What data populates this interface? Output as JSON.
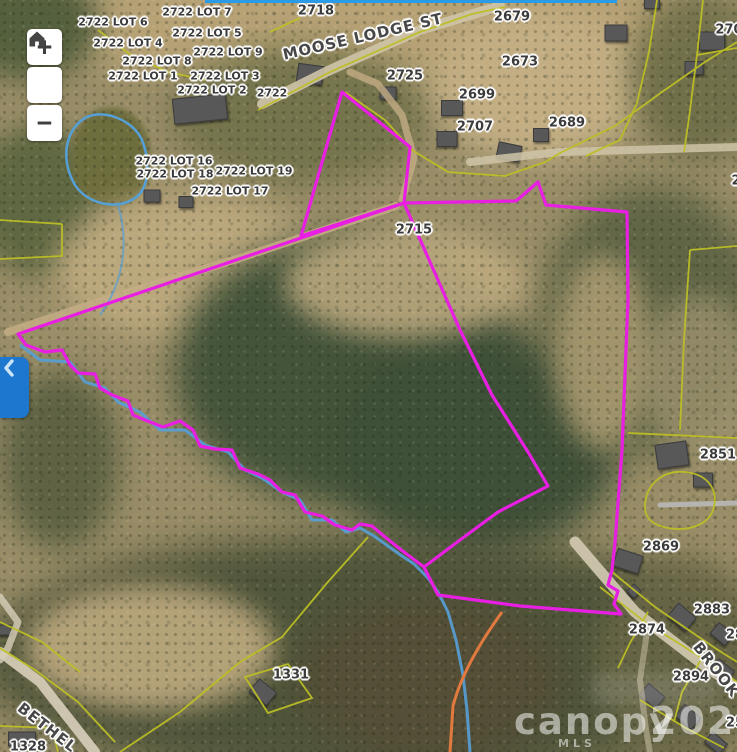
{
  "colors": {
    "selected_boundary": "#e91ee3",
    "parcel_lines": "#bcbf25",
    "water": "#56a0d8",
    "road_casing": "#e2793f",
    "label_text": "#3b3b3b",
    "control_bg": "#ffffff",
    "collapse_bg": "#1d77cf",
    "top_strip": "#2a9be6"
  },
  "controls": {
    "zoom_in": "+",
    "zoom_out": "−",
    "home_icon": "home-icon",
    "collapse_icon": "chevron-left-icon"
  },
  "watermark": {
    "brand": "canopy",
    "mls": "MLS",
    "year": "2025"
  },
  "map": {
    "street_labels": [
      {
        "text": "MOOSE LODGE ST",
        "x": 363,
        "y": 37,
        "rot": -13,
        "size": 15
      },
      {
        "text": "BROOK",
        "x": 716,
        "y": 670,
        "rot": 52,
        "size": 15
      },
      {
        "text": "BETHEL",
        "x": 47,
        "y": 728,
        "rot": 38,
        "size": 15
      }
    ],
    "parcel_labels": [
      {
        "text": "2722 LOT 7",
        "x": 197,
        "y": 12,
        "size": 11
      },
      {
        "text": "2718",
        "x": 316,
        "y": 11,
        "size": 13
      },
      {
        "text": "2722 LOT 6",
        "x": 113,
        "y": 22,
        "size": 11
      },
      {
        "text": "2722 LOT 5",
        "x": 207,
        "y": 33,
        "size": 11
      },
      {
        "text": "2722 LOT 4",
        "x": 128,
        "y": 43,
        "size": 11
      },
      {
        "text": "2722 LOT 9",
        "x": 228,
        "y": 52,
        "size": 11
      },
      {
        "text": "2722 LOT 8",
        "x": 157,
        "y": 61,
        "size": 11
      },
      {
        "text": "2722 LOT 1",
        "x": 143,
        "y": 76,
        "size": 11
      },
      {
        "text": "2722 LOT 3",
        "x": 225,
        "y": 76,
        "size": 11
      },
      {
        "text": "2722 LOT 2",
        "x": 212,
        "y": 90,
        "size": 11
      },
      {
        "text": "2722",
        "x": 272,
        "y": 93,
        "size": 11
      },
      {
        "text": "2679",
        "x": 512,
        "y": 17,
        "size": 13
      },
      {
        "text": "2725",
        "x": 405,
        "y": 76,
        "size": 13
      },
      {
        "text": "2673",
        "x": 520,
        "y": 62,
        "size": 13
      },
      {
        "text": "2699",
        "x": 477,
        "y": 95,
        "size": 13
      },
      {
        "text": "2707",
        "x": 475,
        "y": 127,
        "size": 13
      },
      {
        "text": "2689",
        "x": 567,
        "y": 123,
        "size": 13
      },
      {
        "text": "270",
        "x": 729,
        "y": 30,
        "size": 13
      },
      {
        "text": "2722 LOT 16",
        "x": 174,
        "y": 161,
        "size": 11
      },
      {
        "text": "2722 LOT 18",
        "x": 175,
        "y": 174,
        "size": 11
      },
      {
        "text": "2722 LOT 19",
        "x": 254,
        "y": 171,
        "size": 11
      },
      {
        "text": "2722 LOT 17",
        "x": 230,
        "y": 191,
        "size": 11
      },
      {
        "text": "2715",
        "x": 414,
        "y": 230,
        "size": 13
      },
      {
        "text": "2",
        "x": 736,
        "y": 181,
        "size": 13
      },
      {
        "text": "2851",
        "x": 718,
        "y": 455,
        "size": 13
      },
      {
        "text": "2869",
        "x": 661,
        "y": 547,
        "size": 13
      },
      {
        "text": "2883",
        "x": 712,
        "y": 610,
        "size": 13
      },
      {
        "text": "2874",
        "x": 647,
        "y": 630,
        "size": 13
      },
      {
        "text": "28",
        "x": 735,
        "y": 635,
        "size": 13
      },
      {
        "text": "2894",
        "x": 691,
        "y": 677,
        "size": 13
      },
      {
        "text": "25",
        "x": 735,
        "y": 723,
        "size": 13
      },
      {
        "text": "1331",
        "x": 291,
        "y": 675,
        "size": 13
      },
      {
        "text": "1328",
        "x": 28,
        "y": 747,
        "size": 13
      }
    ],
    "buildings": [
      {
        "x": 200,
        "y": 109,
        "w": 52,
        "h": 24,
        "r": -6
      },
      {
        "x": 152,
        "y": 196,
        "w": 15,
        "h": 11,
        "r": 0
      },
      {
        "x": 186,
        "y": 202,
        "w": 13,
        "h": 10,
        "r": 0
      },
      {
        "x": 310,
        "y": 74,
        "w": 24,
        "h": 17,
        "r": 8
      },
      {
        "x": 388,
        "y": 93,
        "w": 15,
        "h": 11,
        "r": 0
      },
      {
        "x": 452,
        "y": 108,
        "w": 20,
        "h": 14,
        "r": 0
      },
      {
        "x": 447,
        "y": 139,
        "w": 19,
        "h": 14,
        "r": 0
      },
      {
        "x": 509,
        "y": 152,
        "w": 22,
        "h": 15,
        "r": 12
      },
      {
        "x": 541,
        "y": 135,
        "w": 14,
        "h": 12,
        "r": 0
      },
      {
        "x": 616,
        "y": 33,
        "w": 21,
        "h": 15,
        "r": 0
      },
      {
        "x": 694,
        "y": 68,
        "w": 17,
        "h": 12,
        "r": 0
      },
      {
        "x": 712,
        "y": 41,
        "w": 24,
        "h": 17,
        "r": 0
      },
      {
        "x": 652,
        "y": 4,
        "w": 14,
        "h": 8,
        "r": 0
      },
      {
        "x": 672,
        "y": 455,
        "w": 30,
        "h": 23,
        "r": -8
      },
      {
        "x": 703,
        "y": 480,
        "w": 18,
        "h": 13,
        "r": 0
      },
      {
        "x": 628,
        "y": 561,
        "w": 25,
        "h": 17,
        "r": 18
      },
      {
        "x": 682,
        "y": 617,
        "w": 22,
        "h": 16,
        "r": 40
      },
      {
        "x": 722,
        "y": 634,
        "w": 18,
        "h": 13,
        "r": 40
      },
      {
        "x": 722,
        "y": 671,
        "w": 19,
        "h": 14,
        "r": 40
      },
      {
        "x": 652,
        "y": 696,
        "w": 20,
        "h": 14,
        "r": 40
      },
      {
        "x": 688,
        "y": 717,
        "w": 20,
        "h": 14,
        "r": 40
      },
      {
        "x": 716,
        "y": 743,
        "w": 18,
        "h": 12,
        "r": 40
      },
      {
        "x": 263,
        "y": 692,
        "w": 21,
        "h": 15,
        "r": 40
      },
      {
        "x": 22,
        "y": 739,
        "w": 26,
        "h": 13,
        "r": 0
      },
      {
        "x": 4,
        "y": 630,
        "w": 13,
        "h": 9,
        "r": 0
      },
      {
        "x": 634,
        "y": 591,
        "w": 9,
        "h": 9,
        "r": 45
      }
    ]
  }
}
